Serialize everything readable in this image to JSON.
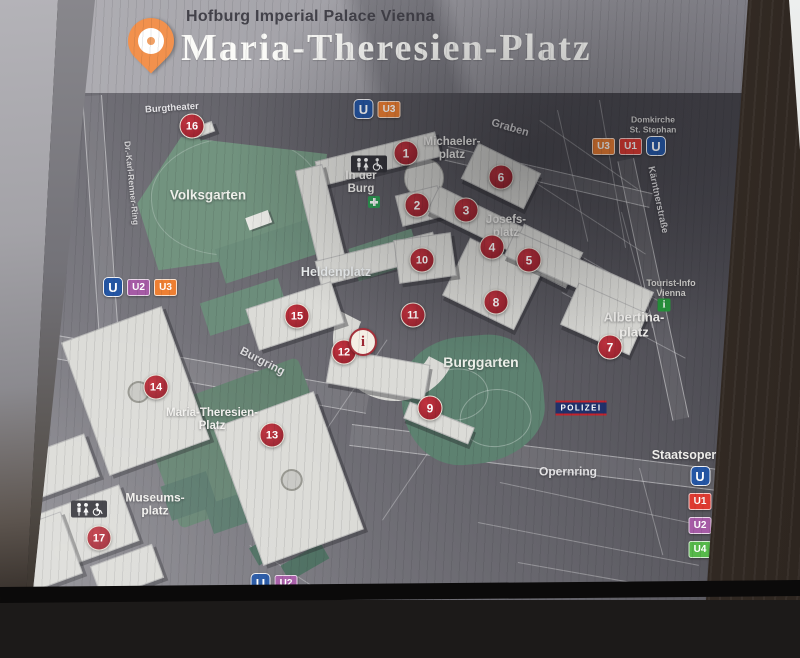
{
  "header": {
    "subtitle": "Hofburg Imperial Palace Vienna",
    "title": "Maria-Theresien-Platz"
  },
  "colors": {
    "marker_red": "#a82430",
    "pin_orange": "#f2914d",
    "u_logo_blue": "#2456a4",
    "U1": "#de3a31",
    "U2": "#a65ba6",
    "U3": "#ee7f32",
    "U4": "#56b94a",
    "tourist_info_green": "#27963c",
    "police_navy": "#20316b"
  },
  "map": {
    "labels": [
      {
        "id": "burgtheater",
        "lines": [
          "Burgtheater"
        ],
        "x": 172,
        "y": 109,
        "size": 9.5,
        "rot": -4,
        "color": "#e8e7ea"
      },
      {
        "id": "volksgarten",
        "lines": [
          "Volksgarten"
        ],
        "x": 208,
        "y": 195,
        "size": 13.5,
        "rot": 0,
        "color": "#eef0ea"
      },
      {
        "id": "michaelerplatz",
        "lines": [
          "Michaeler-",
          "platz"
        ],
        "x": 452,
        "y": 149,
        "size": 11.5,
        "rot": 0,
        "color": "#f3f2ef"
      },
      {
        "id": "graben",
        "lines": [
          "Graben"
        ],
        "x": 510,
        "y": 128,
        "size": 11,
        "rot": 16,
        "color": "#d9d8da"
      },
      {
        "id": "in-der-burg",
        "lines": [
          "In der",
          "Burg"
        ],
        "x": 361,
        "y": 183,
        "size": 11.5,
        "rot": 0,
        "color": "#f3f2ef"
      },
      {
        "id": "josefsplatz",
        "lines": [
          "Josefs-",
          "platz"
        ],
        "x": 506,
        "y": 227,
        "size": 11.5,
        "rot": 0,
        "color": "#f3f2ef"
      },
      {
        "id": "heldenplatz",
        "lines": [
          "Heldenplatz"
        ],
        "x": 336,
        "y": 272,
        "size": 12.5,
        "rot": 0,
        "color": "#eceff0"
      },
      {
        "id": "burgring",
        "lines": [
          "Burgring"
        ],
        "x": 262,
        "y": 362,
        "size": 11.5,
        "rot": 27,
        "color": "#dddcde"
      },
      {
        "id": "albertinaplatz",
        "lines": [
          "Albertina-",
          "platz"
        ],
        "x": 634,
        "y": 325,
        "size": 13,
        "rot": 0,
        "color": "#f3f2ef"
      },
      {
        "id": "tourist-info",
        "lines": [
          "Tourist-Info",
          "Vienna"
        ],
        "x": 671,
        "y": 288,
        "size": 9,
        "rot": 0,
        "color": "#d2d1ce"
      },
      {
        "id": "burggarten",
        "lines": [
          "Burggarten"
        ],
        "x": 481,
        "y": 363,
        "size": 14,
        "rot": 0,
        "color": "#edf0e9"
      },
      {
        "id": "maria-theresien-platz",
        "lines": [
          "Maria-Theresien-",
          "Platz"
        ],
        "x": 212,
        "y": 420,
        "size": 11.5,
        "rot": 0,
        "color": "#f3f2ef"
      },
      {
        "id": "museumsplatz",
        "lines": [
          "Museums-",
          "platz"
        ],
        "x": 155,
        "y": 505,
        "size": 12,
        "rot": 0,
        "color": "#f3f2ef"
      },
      {
        "id": "opernring",
        "lines": [
          "Opernring"
        ],
        "x": 568,
        "y": 472,
        "size": 12,
        "rot": 0,
        "color": "#e3e2e4"
      },
      {
        "id": "staatsoper",
        "lines": [
          "Staatsoper"
        ],
        "x": 684,
        "y": 455,
        "size": 12.5,
        "rot": 0,
        "color": "#f0efec"
      },
      {
        "id": "domkirche-st-stephan",
        "lines": [
          "Domkirche",
          "St. Stephan"
        ],
        "x": 653,
        "y": 125,
        "size": 8.5,
        "rot": 0,
        "color": "#cfcecd"
      },
      {
        "id": "kaerntnerstrasse",
        "lines": [
          "Kärntnerstraße"
        ],
        "x": 657,
        "y": 200,
        "size": 9.5,
        "rot": 78,
        "color": "#d5d4d6"
      },
      {
        "id": "dr-karl-renner-ring",
        "lines": [
          "Dr.-Karl-Renner-Ring"
        ],
        "x": 131,
        "y": 183,
        "size": 8.5,
        "rot": 84,
        "color": "#d5d4d6"
      }
    ],
    "markers": [
      {
        "n": "1",
        "x": 406,
        "y": 153
      },
      {
        "n": "2",
        "x": 417,
        "y": 205
      },
      {
        "n": "3",
        "x": 466,
        "y": 210
      },
      {
        "n": "4",
        "x": 492,
        "y": 247
      },
      {
        "n": "5",
        "x": 529,
        "y": 260
      },
      {
        "n": "6",
        "x": 501,
        "y": 177
      },
      {
        "n": "7",
        "x": 610,
        "y": 347
      },
      {
        "n": "8",
        "x": 496,
        "y": 302
      },
      {
        "n": "9",
        "x": 430,
        "y": 408
      },
      {
        "n": "10",
        "x": 422,
        "y": 260
      },
      {
        "n": "11",
        "x": 413,
        "y": 315
      },
      {
        "n": "12",
        "x": 344,
        "y": 352
      },
      {
        "n": "13",
        "x": 272,
        "y": 435
      },
      {
        "n": "14",
        "x": 156,
        "y": 387
      },
      {
        "n": "15",
        "x": 297,
        "y": 316
      },
      {
        "n": "16",
        "x": 192,
        "y": 126
      },
      {
        "n": "17",
        "x": 99,
        "y": 538
      }
    ],
    "info_marker": {
      "glyph": "i",
      "x": 363,
      "y": 342
    },
    "police_badge": {
      "text": "POLIZEI",
      "x": 581,
      "y": 408
    },
    "ubahn_groups": [
      {
        "id": "u-top-center",
        "x": 377,
        "y": 109,
        "dir": "row",
        "badges": [
          "U",
          "U3"
        ]
      },
      {
        "id": "u-top-right",
        "x": 629,
        "y": 146,
        "dir": "row",
        "badges": [
          "U3",
          "U1",
          "U"
        ]
      },
      {
        "id": "u-mid-left",
        "x": 140,
        "y": 287,
        "dir": "row",
        "badges": [
          "U",
          "U2",
          "U3"
        ]
      },
      {
        "id": "u-bottom-center",
        "x": 274,
        "y": 583,
        "dir": "row",
        "badges": [
          "U",
          "U2"
        ]
      },
      {
        "id": "u-staatsoper-stack",
        "x": 700,
        "y": 512,
        "dir": "col",
        "badges": [
          "U",
          "U1",
          "U2",
          "U4"
        ]
      }
    ],
    "icons": [
      {
        "type": "wc",
        "id": "wc-in-der-burg",
        "x": 369,
        "y": 164
      },
      {
        "type": "wc",
        "id": "wc-museumsplatz",
        "x": 89,
        "y": 509
      },
      {
        "type": "green-cross",
        "id": "first-aid-cross",
        "x": 374,
        "y": 202
      },
      {
        "type": "tourist-info-i",
        "id": "tourist-info-icon",
        "glyph": "i",
        "x": 664,
        "y": 305
      },
      {
        "type": "map-pin",
        "id": "maria-theresien-platz-pin",
        "x": 183,
        "y": 463
      }
    ]
  }
}
